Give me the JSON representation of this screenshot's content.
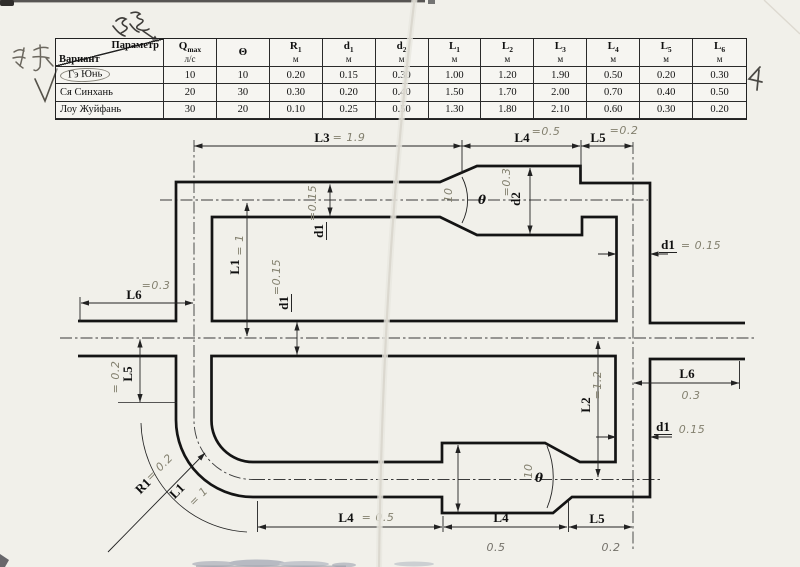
{
  "annotations": {
    "top_chinese": "参数",
    "left_chinese": "海择",
    "checkmark": "√",
    "corner_mark": "4"
  },
  "table": {
    "corner": {
      "top": "Параметр",
      "bottom": "Вариант"
    },
    "columns": [
      {
        "sym": "Q",
        "sub": "max",
        "unit": "л/с"
      },
      {
        "sym": "Θ",
        "sub": "",
        "unit": ""
      },
      {
        "sym": "R",
        "sub": "1",
        "unit": "м"
      },
      {
        "sym": "d",
        "sub": "1",
        "unit": "м"
      },
      {
        "sym": "d",
        "sub": "2",
        "unit": "м"
      },
      {
        "sym": "L",
        "sub": "1",
        "unit": "м"
      },
      {
        "sym": "L",
        "sub": "2",
        "unit": "м"
      },
      {
        "sym": "L",
        "sub": "3",
        "unit": "м"
      },
      {
        "sym": "L",
        "sub": "4",
        "unit": "м"
      },
      {
        "sym": "L",
        "sub": "5",
        "unit": "м"
      },
      {
        "sym": "L",
        "sub": "6",
        "unit": "м"
      }
    ],
    "rows": [
      {
        "name": "Гэ Юнь",
        "circled": true,
        "values": [
          "10",
          "10",
          "0.20",
          "0.15",
          "0.30",
          "1.00",
          "1.20",
          "1.90",
          "0.50",
          "0.20",
          "0.30"
        ]
      },
      {
        "name": "Ся Синхань",
        "circled": false,
        "values": [
          "20",
          "30",
          "0.30",
          "0.20",
          "0.40",
          "1.50",
          "1.70",
          "2.00",
          "0.70",
          "0.40",
          "0.50"
        ]
      },
      {
        "name": "Лоу Жуйфань",
        "circled": false,
        "values": [
          "30",
          "20",
          "0.10",
          "0.25",
          "0.50",
          "1.30",
          "1.80",
          "2.10",
          "0.60",
          "0.30",
          "0.20"
        ]
      }
    ]
  },
  "diagram": {
    "labels": {
      "l3": {
        "label": "L3",
        "value": "= 1.9"
      },
      "l4_top": {
        "label": "L4",
        "value": "=0.5"
      },
      "l5_top": {
        "label": "L5",
        "value": "=0.2"
      },
      "l6_left": {
        "label": "L6",
        "value": "=0.3"
      },
      "l5_left": {
        "label": "L5",
        "value": "= 0.2"
      },
      "l1_top": {
        "label": "L1",
        "value": "= 1"
      },
      "d1_top": {
        "label": "d1",
        "value": "=0.15"
      },
      "d1_mid": {
        "label": "d1",
        "value": "=0.15"
      },
      "d2_top": {
        "label": "d2",
        "value": "=0.3"
      },
      "d1_right_upper": {
        "label": "d1",
        "value": "= 0.15"
      },
      "d1_right_lower": {
        "label": "d1",
        "value": "0.15"
      },
      "l6_right": {
        "label": "L6",
        "value": "0.3"
      },
      "l2": {
        "label": "L2",
        "value": "=1.2"
      },
      "r1": {
        "label": "R1",
        "value": "= 0.2"
      },
      "l1_bend": {
        "label": "L1",
        "value": "= 1"
      },
      "l4_bottom_left": {
        "label": "L4",
        "value": "= 0.5"
      },
      "l4_bottom_mid": {
        "label": "L4",
        "value": "0.5"
      },
      "l5_bottom": {
        "label": "L5",
        "value": "0.2"
      },
      "theta_top": {
        "label": "θ",
        "value": "10"
      },
      "theta_bottom": {
        "label": "θ",
        "value": "10"
      }
    }
  }
}
